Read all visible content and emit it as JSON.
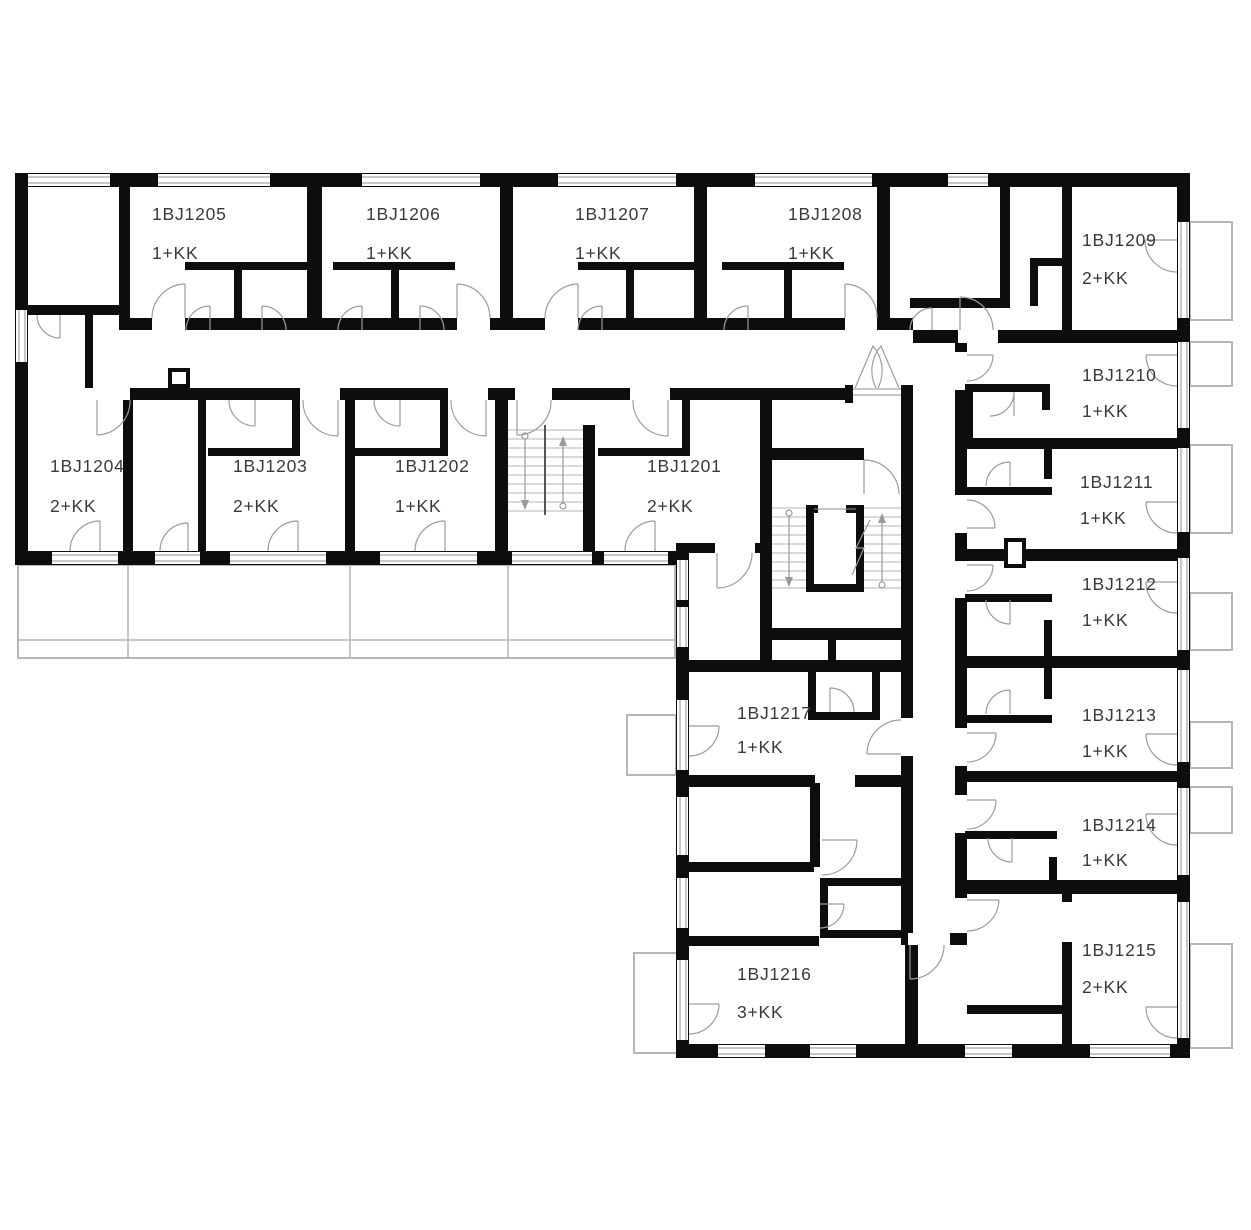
{
  "plan": {
    "drawing_type": "residential floor plan",
    "units": [
      {
        "id": "1BJ1201",
        "type": "2+KK"
      },
      {
        "id": "1BJ1202",
        "type": "1+KK"
      },
      {
        "id": "1BJ1203",
        "type": "2+KK"
      },
      {
        "id": "1BJ1204",
        "type": "2+KK"
      },
      {
        "id": "1BJ1205",
        "type": "1+KK"
      },
      {
        "id": "1BJ1206",
        "type": "1+KK"
      },
      {
        "id": "1BJ1207",
        "type": "1+KK"
      },
      {
        "id": "1BJ1208",
        "type": "1+KK"
      },
      {
        "id": "1BJ1209",
        "type": "2+KK"
      },
      {
        "id": "1BJ1210",
        "type": "1+KK"
      },
      {
        "id": "1BJ1211",
        "type": "1+KK"
      },
      {
        "id": "1BJ1212",
        "type": "1+KK"
      },
      {
        "id": "1BJ1213",
        "type": "1+KK"
      },
      {
        "id": "1BJ1214",
        "type": "1+KK"
      },
      {
        "id": "1BJ1215",
        "type": "2+KK"
      },
      {
        "id": "1BJ1216",
        "type": "3+KK"
      },
      {
        "id": "1BJ1217",
        "type": "1+KK"
      }
    ],
    "colors": {
      "wall": "#0d0d0d",
      "door_swing": "#9c9c9c",
      "window": "#8f8f8f",
      "balcony": "#b6b6b6",
      "label_text": "#3a3a3a",
      "background": "#ffffff"
    }
  }
}
